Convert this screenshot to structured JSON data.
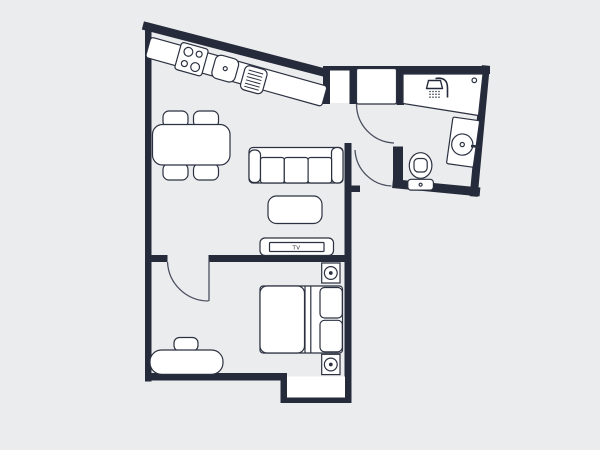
{
  "title": "apartment-floor-plan",
  "colors": {
    "wall": "#252b3a",
    "outline": "#2b3140",
    "floor": "#ebeced",
    "furniture_fill": "#ffffff",
    "door_arc": "#4a5060"
  },
  "labels": {
    "tv": "TV"
  },
  "rooms": [
    {
      "name": "kitchen-living-room",
      "elements": [
        "kitchen-counter",
        "stove-burners",
        "kitchen-sink",
        "drying-rack",
        "dining-table",
        "dining-chairs",
        "sofa",
        "coffee-table",
        "tv-stand"
      ]
    },
    {
      "name": "bathroom",
      "elements": [
        "shower-area",
        "shower-icon",
        "toilet",
        "washbasin",
        "door-knob-dot"
      ]
    },
    {
      "name": "bedroom",
      "elements": [
        "double-bed",
        "pillows",
        "ceiling-speaker-top",
        "ceiling-speaker-bottom",
        "bench",
        "stool",
        "entry-niche"
      ]
    },
    {
      "name": "hallway",
      "elements": [
        "entrance-door-arc",
        "bathroom-door-arc",
        "bedroom-door-arc",
        "storage-niche",
        "entrance-door-panel"
      ]
    }
  ]
}
